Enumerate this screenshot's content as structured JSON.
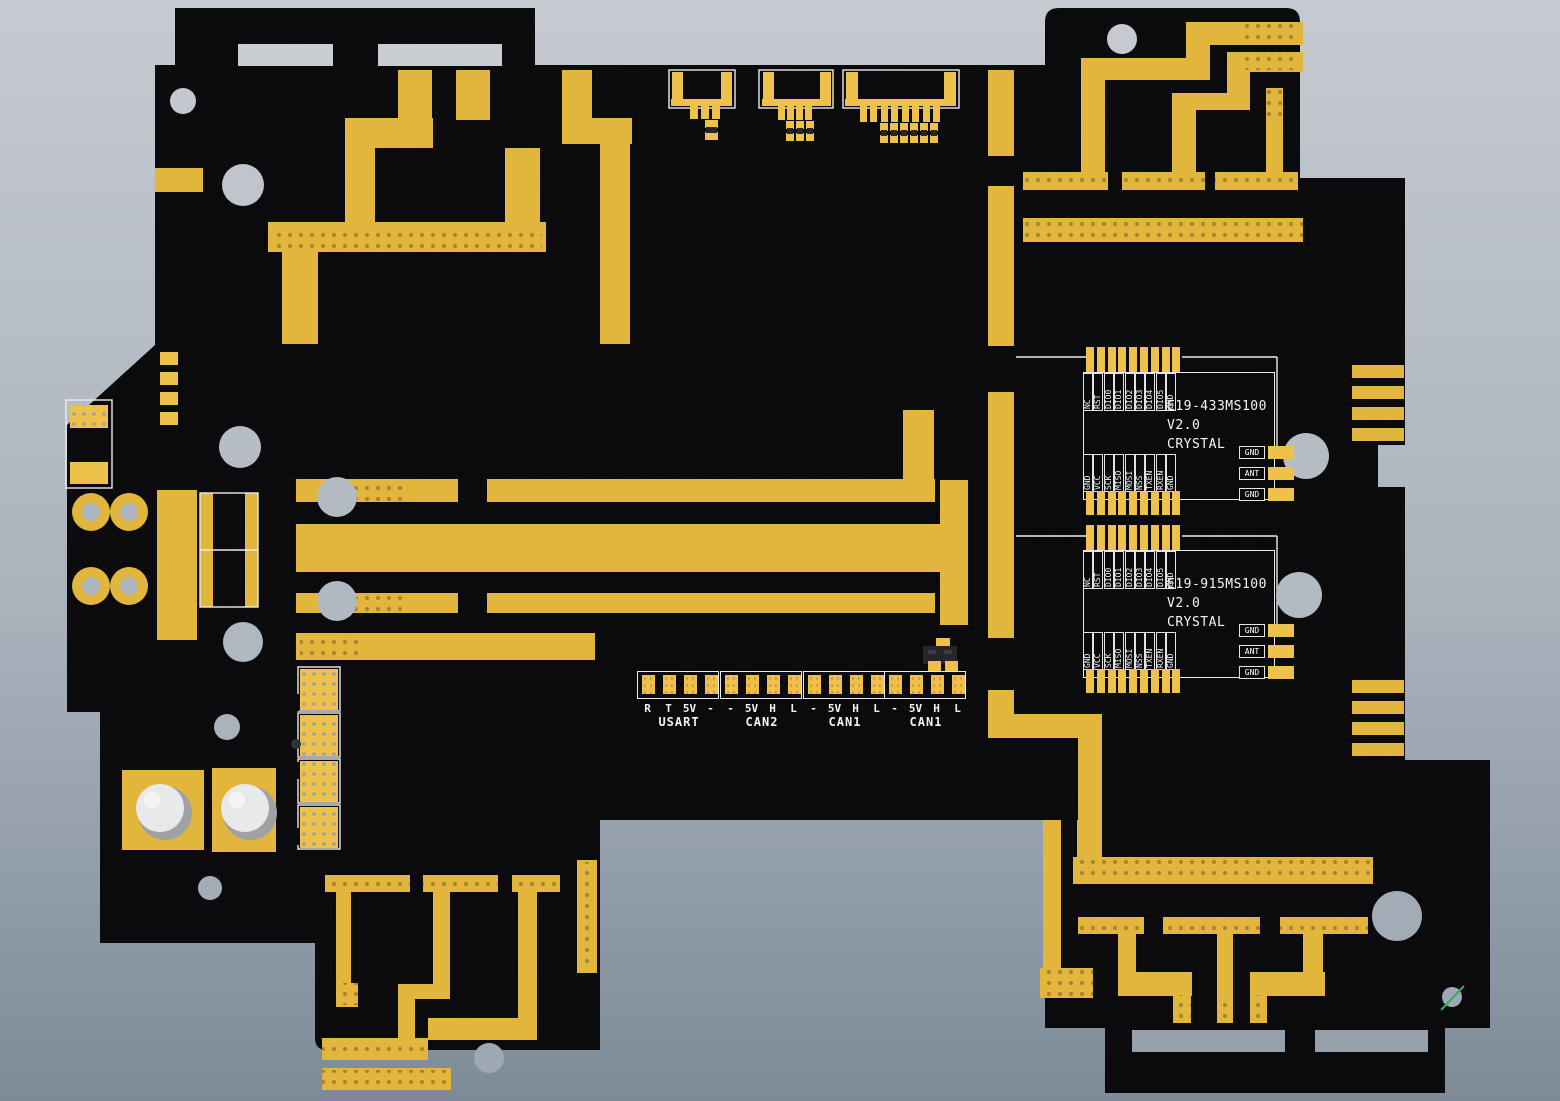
{
  "colors": {
    "bg-top": "#c6cad1",
    "bg-bottom": "#7d8b99",
    "board": "#0b0b0d",
    "copper": "#e2b63d",
    "pad": "#eec14b",
    "silk": "#ebebeb",
    "hole": "#aeb6bf",
    "via": "#a8842f",
    "standoff": "#e8e9ea",
    "green-wire": "#3aa857"
  },
  "modules": [
    {
      "title_line1": "E19-433MS100",
      "title_line2": "V2.0",
      "title_line3": "CRYSTAL",
      "top_pins": [
        "NC",
        "RST",
        "DIO0",
        "DIO1",
        "DIO2",
        "DIO3",
        "DIO4",
        "DIO5",
        "GND"
      ],
      "bottom_pins": [
        "GND",
        "VCC",
        "SCK",
        "MISO",
        "MOSI",
        "NSS",
        "TXEN",
        "RXEN",
        "GND"
      ],
      "rf_pins": [
        "GND",
        "ANT",
        "GND"
      ]
    },
    {
      "title_line1": "E19-915MS100",
      "title_line2": "V2.0",
      "title_line3": "CRYSTAL",
      "top_pins": [
        "NC",
        "RST",
        "DIO0",
        "DIO1",
        "DIO2",
        "DIO3",
        "DIO4",
        "DIO5",
        "GND"
      ],
      "bottom_pins": [
        "GND",
        "VCC",
        "SCK",
        "MISO",
        "MOSI",
        "NSS",
        "TXEN",
        "RXEN",
        "GND"
      ],
      "rf_pins": [
        "GND",
        "ANT",
        "GND"
      ]
    }
  ],
  "connectors": [
    {
      "name": "USART",
      "pins": [
        "R",
        "T",
        "5V",
        "-"
      ]
    },
    {
      "name": "CAN2",
      "pins": [
        "-",
        "5V",
        "H",
        "L"
      ]
    },
    {
      "name": "CAN1",
      "pins": [
        "-",
        "5V",
        "H",
        "L"
      ]
    },
    {
      "name": "CAN1",
      "pins": [
        "-",
        "5V",
        "H",
        "L"
      ]
    }
  ]
}
